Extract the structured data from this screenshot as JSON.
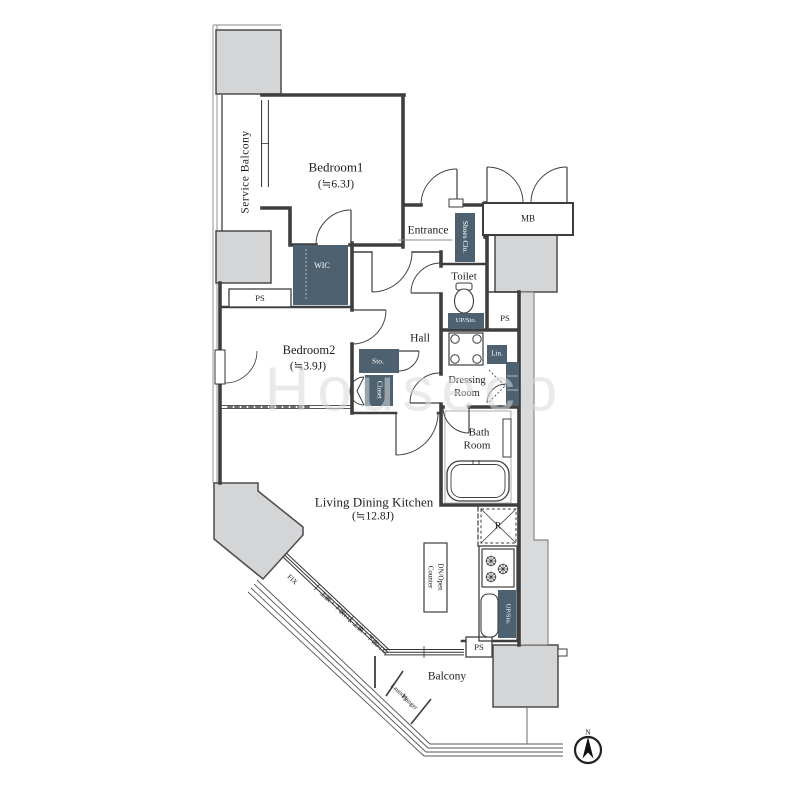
{
  "floorplan": {
    "rooms": {
      "service_balcony": {
        "name": "Service Balcony"
      },
      "bedroom1": {
        "name": "Bedroom1",
        "area": "(≒6.3J)"
      },
      "bedroom2": {
        "name": "Bedroom2",
        "area": "(≒3.9J)"
      },
      "living_dining_kitchen": {
        "name": "Living Dining Kitchen",
        "area": "(≒12.8J)"
      },
      "entrance": {
        "name": "Entrance"
      },
      "hall": {
        "name": "Hall"
      },
      "toilet": {
        "name": "Toilet"
      },
      "dressing_room": {
        "line1": "Dressing",
        "line2": "Room"
      },
      "bath_room": {
        "line1": "Bath",
        "line2": "Room"
      },
      "balcony": {
        "name": "Balcony"
      }
    },
    "storage": {
      "wic": "WIC",
      "shoes_closet": "Shoes Clo.",
      "storage": "Sto.",
      "closet": "Closet",
      "linen": "Lin.",
      "up_sto_toilet": "UP/Sto.",
      "up_sto_kitchen": "UP/Sto."
    },
    "annotations": {
      "mb": "MB",
      "ps_bedroom": "PS",
      "ps_right": "PS",
      "ps_kitchen": "PS",
      "counter_line1": "Counter",
      "counter_line2": "DN/Open",
      "fix": "FIX",
      "window_note": "上嵌・下嵌FIX 上嵌・下嵌FIX",
      "laundry_line1": "Laundry",
      "laundry_line2": "Hanger",
      "refrigerator": "R",
      "north": "N",
      "watermark": "Houseco"
    },
    "colors": {
      "wall": "#3e3e3e",
      "structure_fill": "#d3d5d7",
      "shaft_fill": "#d8dadb",
      "storage_fill": "#4d6170",
      "background": "#ffffff"
    }
  }
}
